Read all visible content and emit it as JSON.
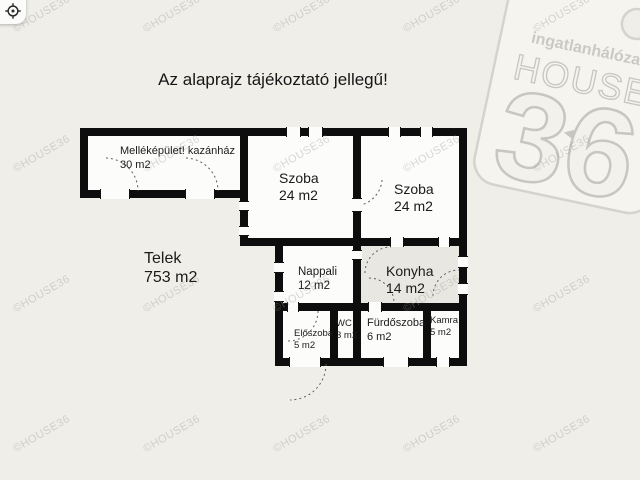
{
  "header": {
    "title": "Az alaprajz tájékoztató jellegű!"
  },
  "watermark": "©HOUSE36",
  "logo": {
    "network": "ingatlanhálózat",
    "house": "HOUSE",
    "number": "36",
    "arrow": "◄"
  },
  "plot": {
    "name": "Telek",
    "area": "753 m2"
  },
  "rooms": {
    "outbuilding": {
      "name": "Melléképület! kazánház",
      "area": "30 m2"
    },
    "room1": {
      "name": "Szoba",
      "area": "24 m2"
    },
    "room2": {
      "name": "Szoba",
      "area": "24 m2"
    },
    "living": {
      "name": "Nappali",
      "area": "12 m2"
    },
    "kitchen": {
      "name": "Konyha",
      "area": "14 m2"
    },
    "hall": {
      "name": "Előszoba",
      "area": "5 m2"
    },
    "wc": {
      "name": "WC",
      "area": "3 m2"
    },
    "bathroom": {
      "name": "Fürdőszoba",
      "area": "6 m2"
    },
    "pantry": {
      "name": "Kamra",
      "area": "5 m2"
    }
  },
  "colors": {
    "background": "#efeee9",
    "wall": "#0d0d0d",
    "room_fill": "#fcfcfb",
    "kitchen_fill": "#e9e7e1",
    "watermark": "#9e9c94"
  }
}
